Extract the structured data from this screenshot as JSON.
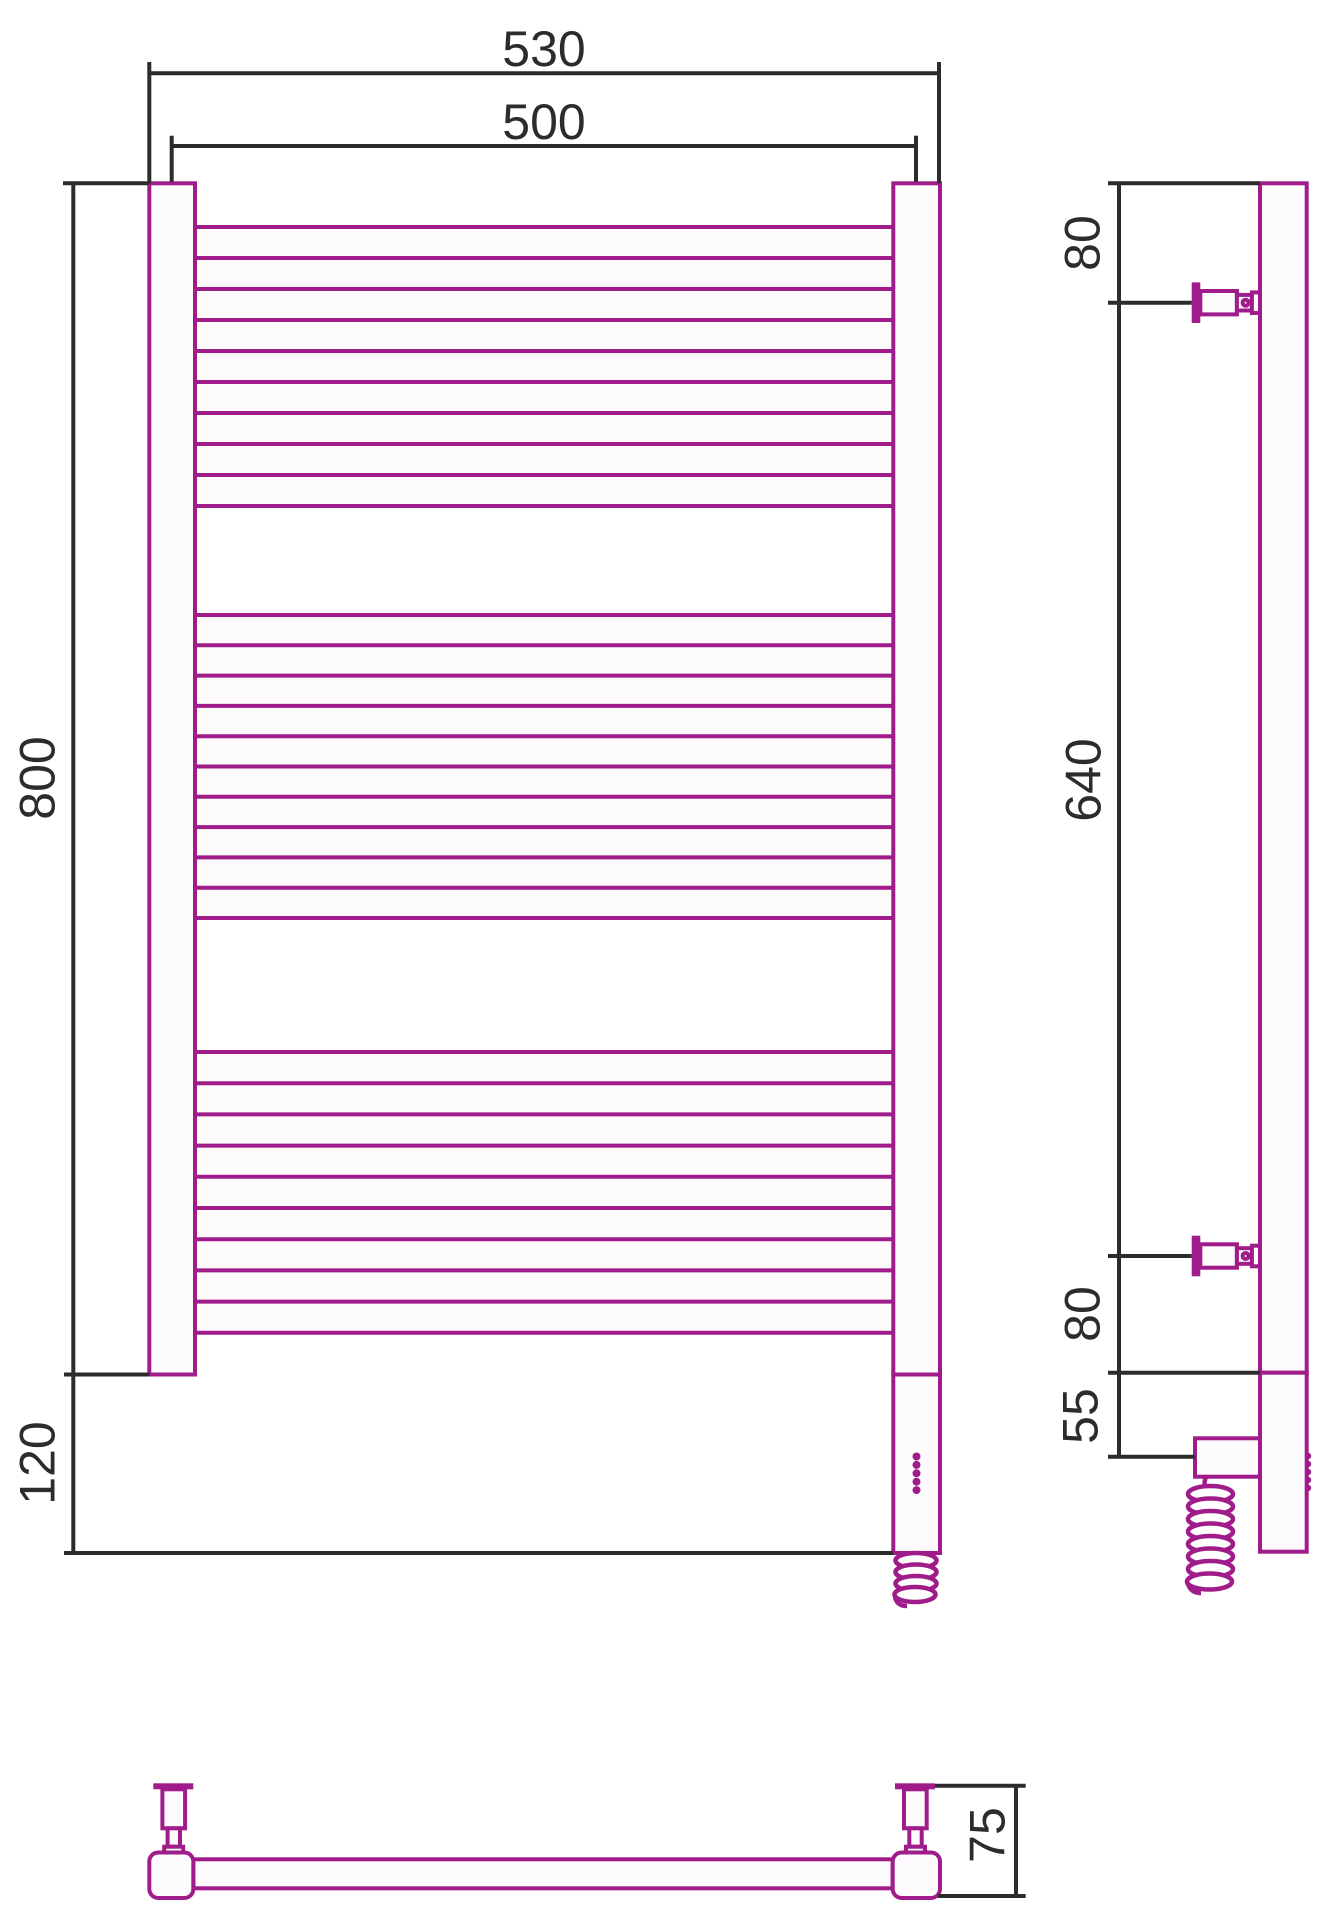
{
  "dimensions": {
    "front": {
      "overall_width": "530",
      "axis_width": "500",
      "rail_height": "800",
      "lower_section": "120"
    },
    "side": {
      "top_to_bracket": "80",
      "between_brackets": "640",
      "bracket_to_bottom": "80",
      "bottom_to_cable": "55"
    },
    "bottom": {
      "wall_depth": "75"
    }
  },
  "colors": {
    "product_outline": "#a01c8a",
    "dimension_lines": "#2d2b2c",
    "paper": "#ffffff"
  }
}
